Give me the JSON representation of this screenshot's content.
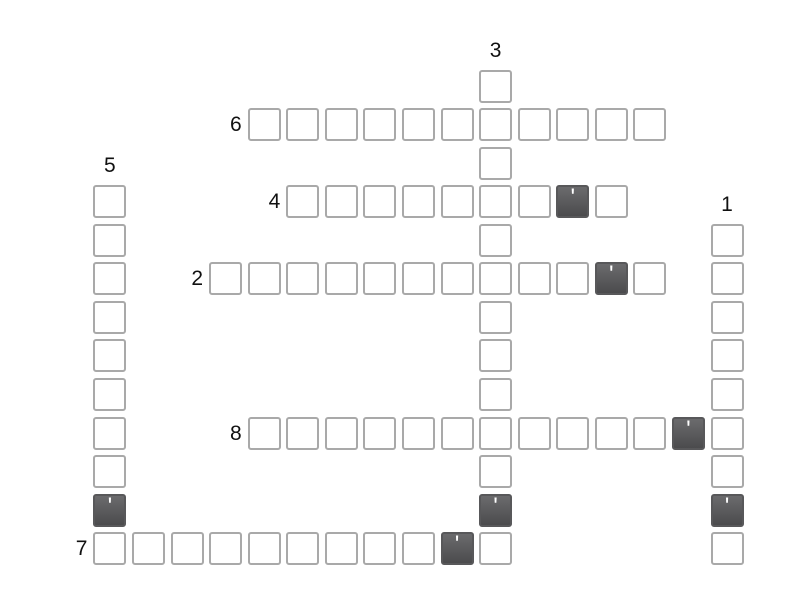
{
  "app": {
    "kind": "crossword-puzzle"
  },
  "colors": {
    "background": "#ffffff",
    "cell_fill": "#ffffff",
    "cell_border": "#a9a9a9",
    "dark_cell_border": "#58585a",
    "dark_cell_top": "#6b6b6d",
    "dark_cell_bottom": "#4b4b4d",
    "prefill_char_color": "#ffffff",
    "label_color": "#111111"
  },
  "grid": {
    "origin_x": 93.4,
    "origin_y": 69.5,
    "pitch": 38.57,
    "cell_size": 33,
    "prefill_char": "'",
    "words": [
      {
        "number": "1",
        "direction": "vertical",
        "col": 16,
        "row": 4,
        "length": 9,
        "prefilled_indices": [
          7
        ]
      },
      {
        "number": "2",
        "direction": "horizontal",
        "col": 3,
        "row": 5,
        "length": 12,
        "prefilled_indices": [
          10
        ]
      },
      {
        "number": "3",
        "direction": "vertical",
        "col": 10,
        "row": 0,
        "length": 13,
        "prefilled_indices": [
          11
        ]
      },
      {
        "number": "4",
        "direction": "horizontal",
        "col": 5,
        "row": 3,
        "length": 9,
        "prefilled_indices": [
          7
        ]
      },
      {
        "number": "5",
        "direction": "vertical",
        "col": 0,
        "row": 3,
        "length": 10,
        "prefilled_indices": [
          8
        ]
      },
      {
        "number": "6",
        "direction": "horizontal",
        "col": 4,
        "row": 1,
        "length": 11,
        "prefilled_indices": []
      },
      {
        "number": "7",
        "direction": "horizontal",
        "col": 0,
        "row": 12,
        "length": 11,
        "prefilled_indices": [
          9
        ]
      },
      {
        "number": "8",
        "direction": "horizontal",
        "col": 4,
        "row": 9,
        "length": 13,
        "prefilled_indices": [
          11
        ]
      }
    ]
  }
}
